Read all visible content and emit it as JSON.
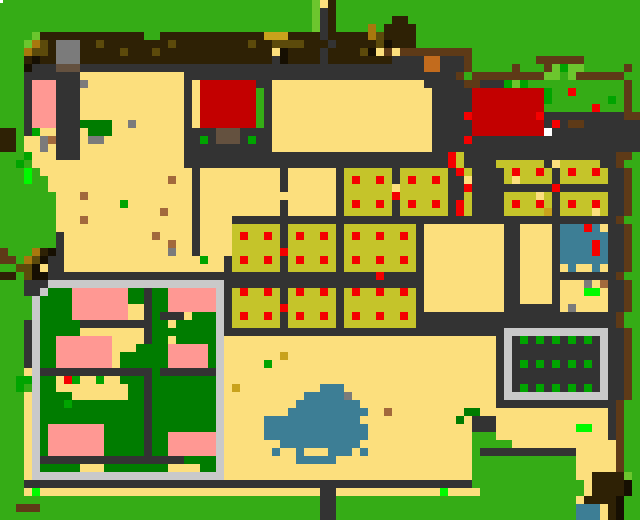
{
  "map": {
    "title_semantic": "pixel-art-village-farm-map",
    "width_px": 640,
    "height_px": 520,
    "cell_px": 8,
    "cols": 80,
    "rows_count": 65,
    "palette": {
      "G": "#35AC16",
      "g": "#6CC62E",
      "E": "#00A400",
      "F": "#00FA00",
      "D": "#007C00",
      "Y": "#FCDF7D",
      "M": "#C9A21C",
      "m": "#C5C42A",
      "d": "#2E2105",
      "o": "#5C4A0B",
      "O": "#A8780E",
      "T": "#64513F",
      "t": "#5E3A17",
      "K": "#160F02",
      "N": "#333333",
      "n": "#7B7B7B",
      "L": "#C9C9C9",
      "P": "#FF9893",
      "R": "#C30000",
      "r": "#F40000",
      "B": "#3D7E95",
      "W": "#FFFFFF",
      "C": "#C26B1D",
      "S": "#A2693C"
    },
    "legend": {
      "G": "grass",
      "g": "light-grass-patch",
      "E": "bush-green",
      "F": "neon-green-marker",
      "D": "dark-green-pen-field",
      "Y": "sand-plaza",
      "M": "gold-tile",
      "m": "crop-field-mustard",
      "d": "dark-soil",
      "o": "olive-soil-clump",
      "O": "ochre-soil-clump",
      "T": "taupe-roof-block",
      "t": "brown-path",
      "K": "near-black-soil",
      "N": "dark-gray-road-wall",
      "n": "stone-gray-block",
      "L": "light-gray-fence",
      "P": "pink-roof-building",
      "R": "red-barn",
      "r": "red-berry-marker",
      "B": "water-pond",
      "W": "white-tile",
      "C": "orange-crate",
      "S": "sienna-crate"
    },
    "artifact_speck": {
      "x": 0,
      "y": 0,
      "w": 3,
      "h": 3,
      "color": "#FFFFFF"
    },
    "rows": [
      "GGGGGGGGGGGGGGGGGGGGGGGGGGGGGGGGGGGGGGGgYdGGGGGGGGGGGGGGGGGGGGGGGGGGGGGGGGGGGGG",
      "GGGGGGGGGGGGGGGGGGGGGGGGGGGGGGGGGGGGGGGgNdGGGGGGGGGGGGGGGGGGGGGGGGGGGGGGGGGGGGG",
      "GGGGGGGGGGGGGGGGGGGGGGGGGGGGGGGGGGGGGGGgNdGGGGGGGddGGGGGGGGGGGGGGGGGGGGGGGGGGGG",
      "GGGGGGGGGGGGGGGGGGGGGGGGGGGGGGGGGGGGGGGgNdGGGGOGddddGGGGGGGGGGGGGGGGGGGGGGGGGGG",
      "GGGGgdddddddddddddffdddddddddddddMMMddddNdddddOoddddGGGGGGGGGGGGGGGGGGGGGGGGGGGG",
      "GGGgOodnnnddoddddddddodddddddddoddoooodddNdddddoKdddGGGGGGGGGGGGGGGGGGGGGGGGGGGG",
      "GGGOoodnnndddddodddoddddddddddddddYKddddNddddoKYtYtttttttttGGGGGGGGGGGGGGGGGGGGG",
      "GGGdKddnnnddddddddddddddddddddddddNKddddNddddddddNNNNCCNNNtGGGGGGGGttttttGGGGGGG",
      "GGGKNNNTTTNNNNNNNNNNNNNNNNNNNNNNNNNNNNNNNNNNNNNNNNNNNCCNNNtGGGGGtGGGtgEggGGGGGtG",
      "GGGNNNNNNNYYYYYYYYYYYYYNNNNNNNNNNNNNNNNNNNNNNNNNNNNNNNNNNtGtttttttttggGgttttttG",
      "GGGNPPPNNNnYYYYYYYYYYYYNYRRRRRRRNNYYYYYYYYYYYYYYYYYYYNNNNNttNNNEgEGGGGGGGGGGGGtG",
      "GGGNPPPNNNYYYYYYYYYYYYYNYRRRRRRRGNYYYYYYYYYYYYYYYYYYYYNNNNNRRRRRRRRREGGrGGGGGGtG",
      "GGGNPPPNNNYYYYYYYYYYYYYNYRRRRRRRGNYYYYYYYYYYYYYYYYYYYYNNNNNRRRRRRRRREGGGGGGGEGtG",
      "GGGNPPPNNNYYYYYYYYYYYYYNYRRRRRRRGNYYYYYYYYYYYYYYYYYYYYNNNNNRRRRRRRRRGGGGGGrGGGtG",
      "GGGNPPPNNNYYYYYYYYYYYYYNYRRRRRRRGNYYYYYYYYYYYYYYYYYYYYNNNNrRRRRRRRRrNNNNNNNNNNtt",
      "GGGNPPPNNNDDDDYYnYYYYYYNYRRRRRRRGNYYYYYYYYYYYYYYYYYYYYNNNNNRRRRRRRRRNrNttNNNNNNN",
      "ddGNEYYNNNYDDDYYYYYYYYYNNNNTTTNNNNYYYYYYYYYYYYYYYYYYYYNNNNNRRRRRRRRRWNNNNNNNNNNN",
      "ddGYYnSNNNYnnYYYYYYYYYYNNENTTTNENNYYYYYYYYYYYYYYYYYYYYNNNNrNNNNNNNNNNNNNNNNNNNNN",
      "ddGYYnYNNNYYYYYYYYYYYYYNNNNNNNNNNNYYYYYYYYYYYYYYYYYYYYNNNNNNNNNNNNNNNNNNNNNNNNNN",
      "GGGEYYYNNNYYYYYYYYYYYYYNNNNNNNNNNNNNNNNNNNNNNNNNNNNNNNNNrmNNNNNNNNNNNNNNNNNNNtt",
      "GGEGYYYYYYYYYYYYYYYYYYYNNNNNNNNNNNNNNNNNNNNNNNNNNNNNNNNNrmNNNNmmmmmmNYmmmmmNNtG",
      "GGGFGYYYYYYYYYYYYYYYYYYYNYYYYYYYYYYNYYYYYYNmmmmmmNmmmmmmNrmNNNNmrmmrmNmrmmrmNNtG",
      "GGGFGGYYYYYYYYYYYYYYYSYYNYYYYYYYYYYNYYYYYYNmrmmrmNmrmmrmNNYNNNNmYmmmmNmmmmmmNNtG",
      "GGGGGGYYYYYYYYYYYYYYYYYYNYYYYYYYYYYNYYYYYYNmmmmmmYmmmmmmNNrNNNNNNNNNNrNNNNNNNNtG",
      "GGGGGGGYYYSYYYYYYYYYYYYYNYYYYYYYYYYYYYYYYYNmmmmmmrmmmmmmNNmNNNNmmmmYmNmmmmmmNNtG",
      "GGGGGGGYYYYYYYYEYYYYYYYYNYYYYYYYYYYNYYYYYYNmrmmrmNmrmmrmNrmNNNNmrmmrmNmrmmrmNNtG",
      "GGGGGGGYYYYYYYYYYYYYSYYYNYYYYYYYYYYNYYYYYYNmmmmmmNmmmmmmNrmNNNNmmmmmMNmmmmYmNNtG",
      "GGGGGGGYYYSYYYYYYYYYYYYYNYYYYNNNNNNNNNNNNNNNNNNNNNNNNNNNNNNNNNNNNNNNNNNNNNNNNtG",
      "GGGGGGGYYYYYYYYYYYYYYYYYNYYYYmmmmmmNmmmmmmNmmmmmmmmmNYYYYYYYYYYNNYYYYNBBBrBYNNtG",
      "GGGGGGGNYYYYYYYYYYYSYYYYNYYYYmrmmrmNmrmmrmNmrmmrmmrmNYYYYYYYYYYNNYYYYNBBBBBBNNtG",
      "GGGGGGGNYYYYYYYYYYYYYSYYNYYYYmmmmmmNmmmmmmNmmmmmmmmmNYYYYYYYYYYNNYYYYNBBBBrBNNtG",
      "tGGGOdKNYYYYYYYYYYYYYnYYNYYYYmmmmmmrmmmmmmNmmmmmmmmmNYYYYYYYYYYNNYYYYNBBBBrBNNtG",
      "ttGOoKNNYYYYYYYYYYYYYYYYYEYYNmrmmrmNmrmmrmNmrmmrmmrmNYYYYYYYYYYNNYYYYNBBBBBBNNtG",
      "GGooKYNNYYYYYYYYYYYYYYYYYYYYNmmmmmmNmmmmmmNmmmmmmmmmNYYYYYYYYYYNNYYYYNYBYYBYNNtG",
      "ddGoKKNNNNNNNNNNNNNNNNNNNNNNNNNNNNNNNNNNNNNNNNNrNNNNNYYYYYYYYYYNNYYYYNNNNNNNNtG",
      "GGGNNNLLLLLLLLLLLLLLLLLLLLLLNNNNNNNNNNNNNNNNNNNNNNNNNYYYYYYYYYYNNYYYYNYYYnYSNNtG",
      "GGGNNLDDDPPPPPPPDDNDDPPPPPPLNmrmmrmNmrmmrmNmrmmrmmrmNYYYYYYYYYYNNYYYYNYYYFFYNNtG",
      "GGGGLDDDDPPPPPPPDDNDDPPPPPPLNmmmmmmNmmmmmmNmmmmmmmmmNYYYYYYYYYYNNYYYYNYYYYYYNNtG",
      "GGGGLDDDDPPPPPPPYYNDDPPPPPPLNmmmmmmrmmmmmmNmmmmmmmmmNYYYYYYYYYYNNNNNNNYnYYYYNNtG",
      "GGGGLDDDDPPPPPPPYYNDNNNYDDDLNmrmmrmNmrmmrmNmrmmrmmrmNNNNNNNNNNNNNNNNNNNNNNNNNtG",
      "GGGNLDDDDDNNNNNNNNNDDYDDDDDLNmmmmmmNmmmmmmNmmmmmmmmmNNNNNNNNNNNNNNNNNNNNNNNNNtG",
      "GGGNLDDDDDYYYYYYYYNDDDDDDDDLNNNNNNNNNNNNNNNNNNNNNNNNNNNNNNNNNNNLLLLLLLLLLLLLNNtG",
      "GGGNLDDPPPPPPPYYYYNDDYDDDDDLYYYYYYYYYYYYYYYYYYYYYYYYYYYYYYYYYYNLNENENENENENLNNtG",
      "GGGNLDDPPPPPPPYYYDDDDPPPPPDLYYYYYYYYYYYYYYYYYYYYYYYYYYYYYYYYYYNLNNNNNNNNNNNLNNtG",
      "GGGNLDDPPPPPPPYDDDDDDPPPPPDLYYYYYYYMYYYYYYYYYYYYYYYYYYYYYYYYYYNLNNNNNNNNNNNLNNtG",
      "GGGNLDDPPPPPPPYDDDDDDPPPPPDLYYYYYEYYYYYYYYYYYYYYYYYYYYYYYYYYYYNLNENENENENENLNNtG",
      "GGGYLNNNNNNNNNNNNNNDNNNNNNNLYYYYYYYYYYYYYYYYYYYYYYYYYYYYYYYYYYNLNNNNNNNNNNNLNNtG",
      "GGEELDDYrEYYEYYDDDNDDDDDDDDLYYYYYYYYYYYYYYYYYYYYYYYYYYYYYYYYYYNLNNNNNNNNNNNLNNtG",
      "GGEGLDDYYYYYYYYYDDNDDDDDDDDLYMYYYYYYYYYYBBBYYYYYYYYYYYYYYYYYYYNLNENENENENENLNNtG",
      "GGGYLDDDDYYYYYYYDDNDDDDDDDDLYYYYYYYYYYBBBBBnYYYYYYYYYYYYYYYYYYNLLLLLLLLLLLLLNNtG",
      "GGGYLDDDEDDDDDDDDDNDDDDDDDDLYYYYYYYYYBBBBBBBBYYYYYYYYYYYYYYYYYNNNNNNNNNNNNNNNtG",
      "GGGYLDDDDDDDDDDDDDNDDDDDDDDLYYYYYYYYBBBBBBBBBBYYSYYYYYYYYYDDYYYYYYYYYYYYYYYYNtG",
      "GGGYLDDDDDDDDDDDDDNDDDDDDDDLYYYYYBBBBBBBBBBBBYYYYYYYYYYYYDYNNNYYYYYYYYYYYYYYNtG",
      "GGGYLDPPPPPPPDDDDDNDDDDDDDDLYYYYYBBBBBBBBBBBBBYYYYYYYYYYYYYNNNYYYYYYYYYYFFYYNtG",
      "GGGYLDPPPPPPPDDDDDNDDPPPPPPLYYYYYBBBBBBBBBBBBBYYYYYYYYYYYYYGGGYYYYYYYYYYYYYYNtG",
      "GGGYLDPPPPPPPDDDDDNDDPPPPPPLYYYYYYYBBBBBBBBBBYYYYYYYYYYYYYYGGGGGYYYYYYYYYYYYYtG",
      "GGGYLDPPPPPPPDDDDDNDDPPPPPPLYYYYYYBYYBYYYBBBYBYYYYYYYYYYYYYGNNNNNNNNNNNNYYYYYtG",
      "GGGYLNNNNNNNNNNNNNNNNNNDDDDLYYYYYYYYYBBBBBYYYYYYYYYYYYYYYYYGGGGGGGGGGGGGYYYYYtG",
      "GGGYLDDDDDYYYDDDDDDDDYYYYDDLYYYYYYYYYYYYYYYYYYYYYYYYYYYYYYYGGGGGGGGGGGGGYYYYYtG",
      "GGGYLLLLLLLLLLLLLLLLLLLLLLLLYYYYYYYYYYYYYYYYYYYYYYYYYYYYYYYGGGGGGGGGGGGGYYddddg",
      "GGGNNNNNNNNNNNNNNNNNNNNNNNNNNNNNNNNNNNNNNNNNNNNNNNNNNNNNNNNGGGGGGGGGGGGGGYddddK",
      "GGGYFYYYYYYYYYYYYYYYYYYYYYYYYYYYYYYYYYYYNNYYYYYYYYYYYYYFYYYYGGGGGGGGGGGGGYddddK",
      "GGGGGGGGGGGGGGGGGGGGGGGGGGGGGGGGGGGGGGGGNNGGGGGGGGGGGGGGGGGGGGGGGGGGGGGGYddddK",
      "GGtttGGGGGGGGGGGGGGGGGGGGGGGGGGGGGGGGGGGNNGGGGGGGGGGGGGGGGGGGGGGGGGGGGGGBBBYdK",
      "GGGGGGGGGGGGGGGGGGGGGGGGGGGGGGGGGGGGGGGGNNGGGGGGGGGGGGGGGGGGGGGGGGGGGGGGBBBYdK"
    ]
  }
}
